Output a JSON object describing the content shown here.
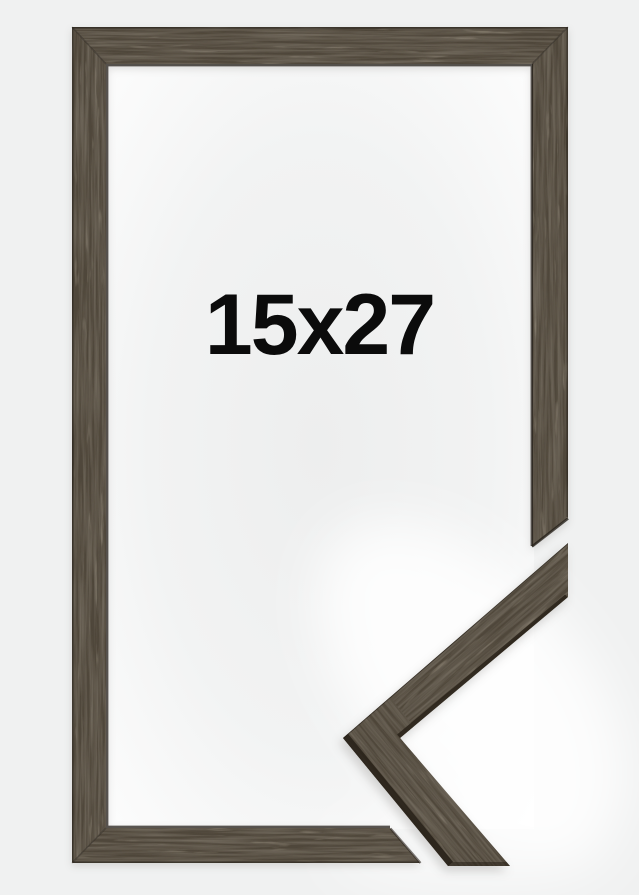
{
  "product_image": {
    "size_label": "15x27"
  },
  "colors": {
    "background": "#f0f1f1",
    "inner_center": "#edeeee",
    "inner_mid": "#f2f3f3",
    "inner_edge": "#fdfdfd",
    "halo": "#ffffff",
    "wood_base": "#50473a",
    "wood_streak_dark": "#2e2820",
    "wood_streak_light": "#6e604c",
    "wood_edge_dark": "#292219",
    "label_text": "#0b0b0b"
  }
}
